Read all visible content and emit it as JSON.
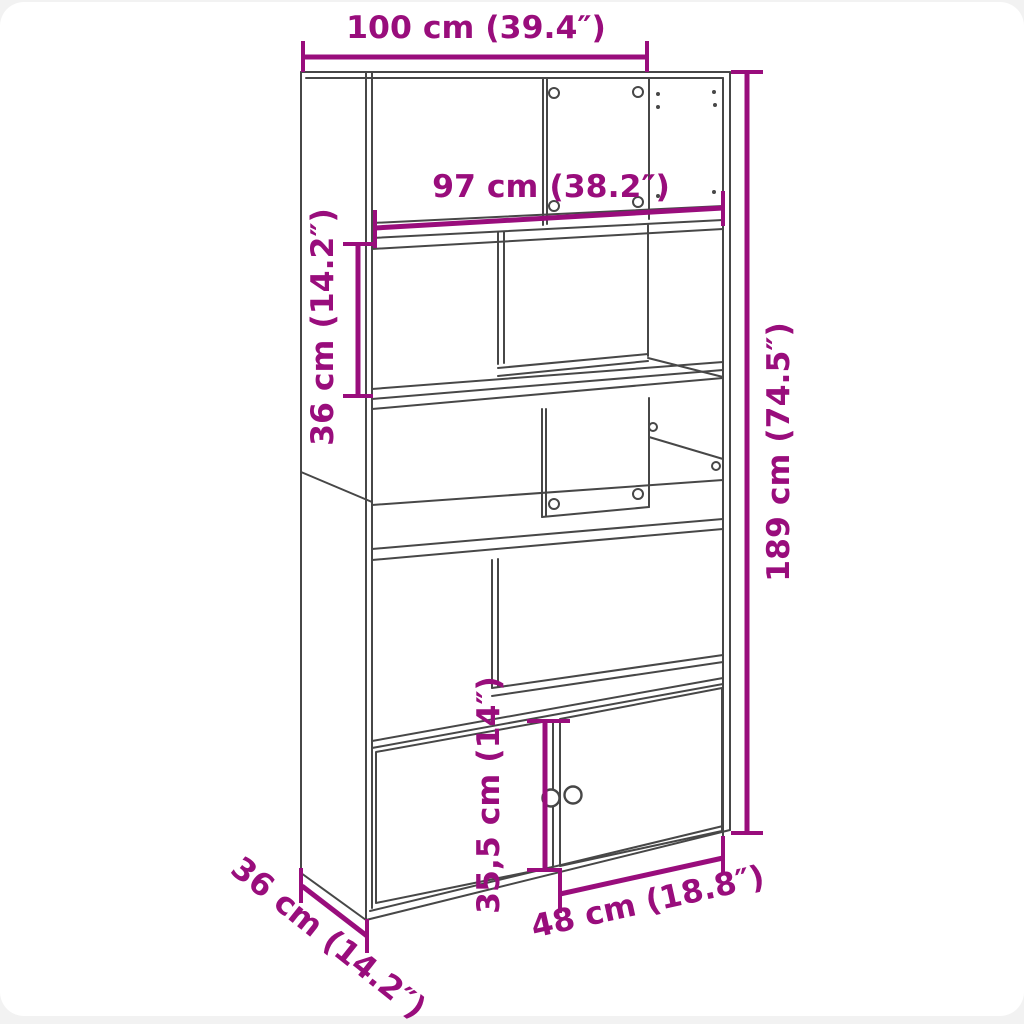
{
  "figure": {
    "subject": "bookcase dimension line drawing",
    "background_color": "#F2F2F2",
    "canvas_color": "#FFFFFF",
    "outline_color": "#474747",
    "dimension_color": "#990D7C"
  },
  "dimensions": {
    "overall_width": {
      "cm": "100",
      "inches": "39.4",
      "label": "100 cm (39.4″)"
    },
    "shelf_width": {
      "cm": "97",
      "inches": "38.2",
      "label": "97 cm (38.2″)"
    },
    "compartment_height": {
      "cm": "36",
      "inches": "14.2",
      "label": "36 cm (14.2″)"
    },
    "overall_height": {
      "cm": "189",
      "inches": "74.5",
      "label": "189 cm (74.5″)"
    },
    "door_height": {
      "cm": "35,5",
      "inches": "14",
      "label": "35,5 cm (14″)"
    },
    "door_width": {
      "cm": "48",
      "inches": "18.8",
      "label": "48 cm (18.8″)"
    },
    "depth": {
      "cm": "36",
      "inches": "14.2",
      "label": "36 cm (14.2″)"
    }
  }
}
